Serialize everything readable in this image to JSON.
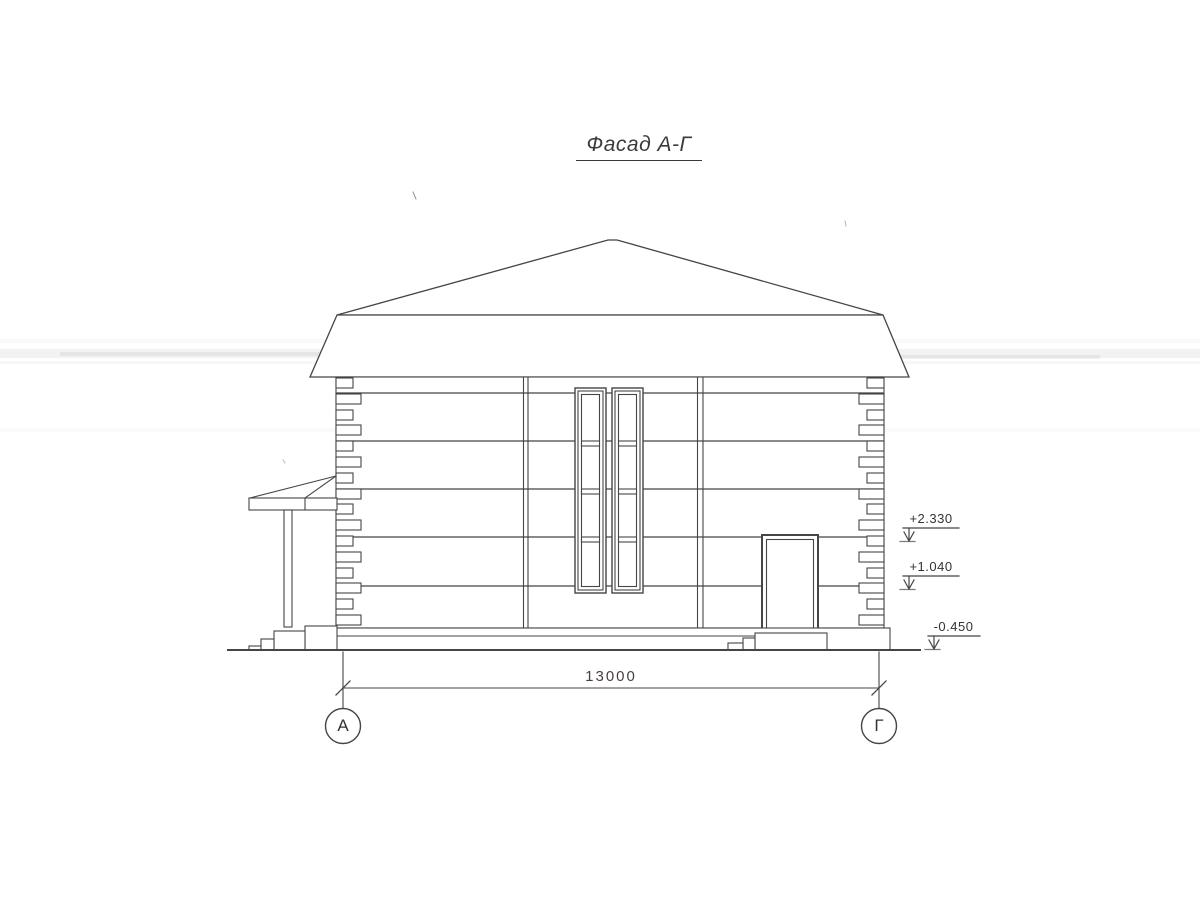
{
  "drawing": {
    "title": "Фасад А-Г",
    "dimension_value": "13000",
    "axis_left": "А",
    "axis_right": "Г",
    "elevation_marks": [
      "+2.330",
      "+1.040",
      "-0.450"
    ]
  },
  "colors": {
    "line": "#414141",
    "paper": "#ffffff"
  }
}
